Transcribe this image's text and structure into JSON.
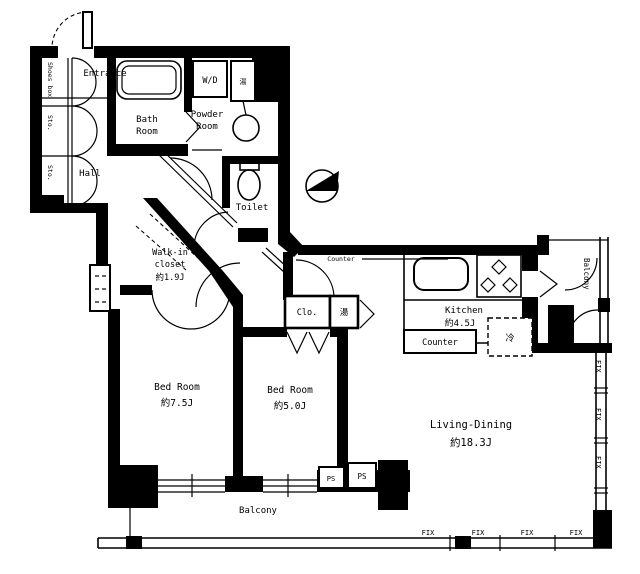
{
  "plan_title": "apartment-floor-plan",
  "colors": {
    "wall": "#000000",
    "background": "#ffffff"
  },
  "rooms": {
    "entrance": "Entrance",
    "hall": "Hall",
    "bath": [
      "Bath",
      "Room"
    ],
    "powder": [
      "Powder",
      "Room"
    ],
    "toilet": "Toilet",
    "niche": "Niche",
    "walk_in_closet": [
      "Walk-in",
      "closet",
      "約1.9J"
    ],
    "bedroom_left": [
      "Bed Room",
      "約7.5J"
    ],
    "bedroom_center": [
      "Bed Room",
      "約5.0J"
    ],
    "living_dining": [
      "Living-Dining",
      "約18.3J"
    ],
    "kitchen": [
      "Kitchen",
      "約4.5J"
    ],
    "closet": "Clo.",
    "balcony_bottom": "Balcony",
    "balcony_right": "Balcony"
  },
  "fixtures": {
    "washer_dryer": "W/D",
    "water_heater_top": "湯",
    "water_heater_mid": "湯",
    "refrigerator": "冷",
    "shoes_box": "Shoes box",
    "storage_top": "Sto.",
    "storage_bottom": "Sto.",
    "kitchen_counter": "Counter",
    "wall_counter": "Counter",
    "pipe_space_left": "PS",
    "pipe_space_right": "PS"
  },
  "windows": {
    "fix_bottom": [
      "FIX",
      "FIX",
      "FIX",
      "FIX"
    ],
    "fix_right": [
      "FIX",
      "FIX",
      "FIX"
    ]
  }
}
